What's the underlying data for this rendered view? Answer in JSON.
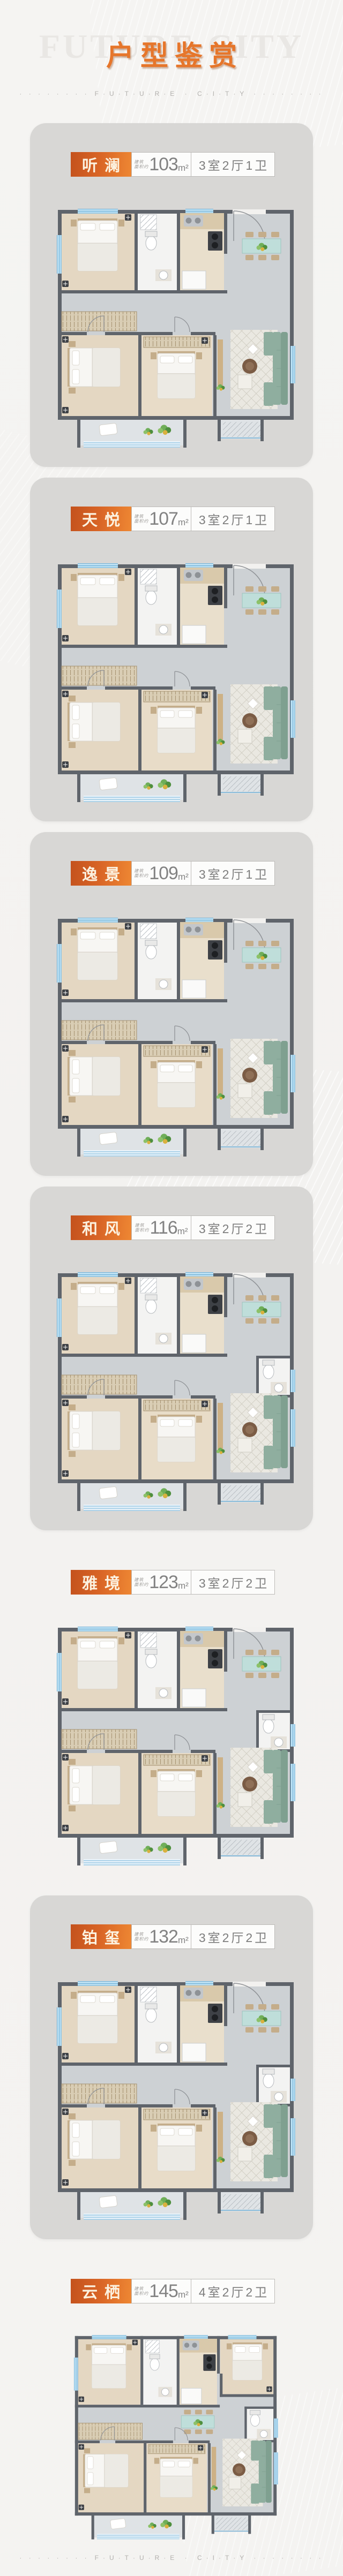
{
  "page": {
    "title": "户型鉴赏",
    "watermark": "FUTURE CITY",
    "dots": "· · · · · · · ·",
    "subtitle": "F·U·T·U·R·E · C·I·T·Y"
  },
  "labels": {
    "area_prefix_line1": "建筑",
    "area_prefix_line2": "面积约",
    "area_unit": "m²"
  },
  "plans": [
    {
      "name": "听澜",
      "area": "103",
      "config": "3室2厅1卫"
    },
    {
      "name": "天悦",
      "area": "107",
      "config": "3室2厅1卫"
    },
    {
      "name": "逸景",
      "area": "109",
      "config": "3室2厅1卫"
    },
    {
      "name": "和风",
      "area": "116",
      "config": "3室2厅2卫"
    },
    {
      "name": "雅境",
      "area": "123",
      "config": "3室2厅2卫"
    },
    {
      "name": "铂玺",
      "area": "132",
      "config": "3室2厅2卫"
    },
    {
      "name": "云栖",
      "area": "145",
      "config": "4室2厅2卫"
    }
  ],
  "colors": {
    "accent": "#e6762b",
    "tag_gradient_left": "#c4521d",
    "tag_gradient_right": "#ee8733",
    "tag_text": "#fcf2e0",
    "card_background": "#d8d7d5",
    "page_background": "#f3f2f0",
    "info_text": "#828282",
    "plan": {
      "wall": "#5f646b",
      "living": "#cdd1d4",
      "wood": "#e4d7c2",
      "wood2": "#c4ad8a",
      "kitchen": "#e9dfcc",
      "bath": "#f3f3f2",
      "counter": "#d9c9ab",
      "window": "#bfe2f4",
      "winframe": "#6fb0d6",
      "sofa": "#8fae9f",
      "sofa2": "#7fa090",
      "rug": "#eae8e1",
      "rugline": "#d2cfc5",
      "table": "#bfdeda",
      "plant": "#6fae58",
      "plant2": "#4e8f3e",
      "dark": "#3e4146",
      "door": "#8f9296",
      "balcony": "#dfe3e6",
      "mattress": "#f7f6f3",
      "blanket": "#eceae4"
    }
  }
}
